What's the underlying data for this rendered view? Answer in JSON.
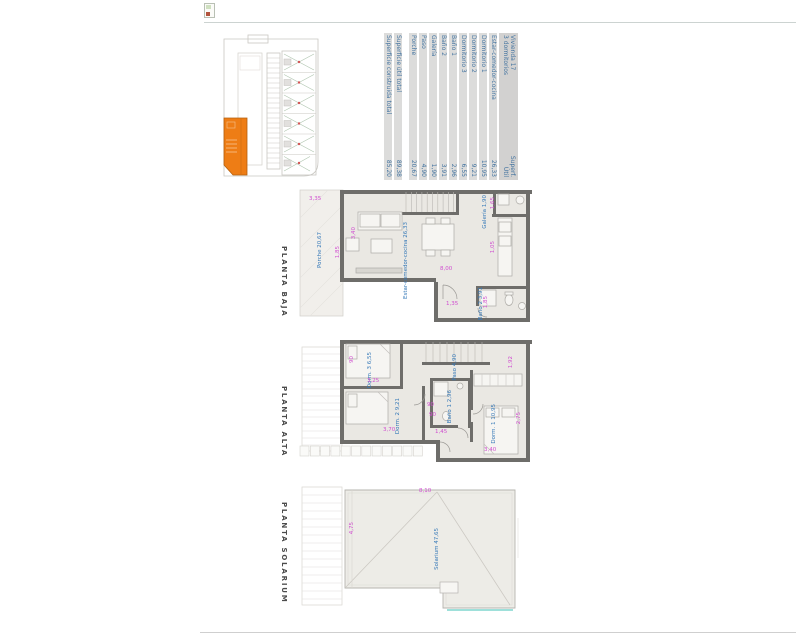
{
  "page": {
    "top_icon": "image-placeholder-icon",
    "background": "#ffffff"
  },
  "colors": {
    "highlight_orange": "#ee7d15",
    "label_blue": "#3679b8",
    "dimension_magenta": "#d04ed0",
    "teal_accent": "#7ed6cd",
    "table_strip_gray": "#dcdcdb",
    "wall_gray": "#6e6d6a"
  },
  "table": {
    "header": {
      "title_line1": "Vivienda 17",
      "title_line2": "3 dormitorios",
      "unit_line1": "Superf.",
      "unit_line2": "Útil"
    },
    "rows": [
      {
        "label": "Estar-comedor-cocina",
        "value": "26,33"
      },
      {
        "label": "Dormitorio 1",
        "value": "10,95"
      },
      {
        "label": "Dormitorio 2",
        "value": "9,21"
      },
      {
        "label": "Dormitorio 3",
        "value": "6,55"
      },
      {
        "label": "Baño 1",
        "value": "2,96"
      },
      {
        "label": "Baño 2",
        "value": "3,91"
      },
      {
        "label": "Galería",
        "value": "1,90"
      },
      {
        "label": "Paso",
        "value": "4,90"
      },
      {
        "label": "Porche",
        "value": "20,67"
      }
    ],
    "totals": [
      {
        "label": "Superficie útil total",
        "value": "89,38"
      },
      {
        "label": "Superficie construida total",
        "value": "85,20"
      }
    ]
  },
  "site_plan": {
    "highlighted_unit": "Vivienda 17"
  },
  "plans": {
    "baja": {
      "title": "PLANTA BAJA",
      "labels": [
        {
          "text": "Porche 20,67",
          "x": 317,
          "y": 232,
          "dir": "v",
          "c": "blue"
        },
        {
          "text": "Estar-comedor-cocina 26,33",
          "x": 403,
          "y": 222,
          "dir": "v",
          "c": "blue"
        },
        {
          "text": "Galería 1,90",
          "x": 482,
          "y": 195,
          "dir": "v",
          "c": "blue"
        },
        {
          "text": "Baño 2 3,91",
          "x": 478,
          "y": 287,
          "dir": "v",
          "c": "blue"
        },
        {
          "text": "3,35",
          "x": 309,
          "y": 196,
          "dir": "h",
          "c": "magenta"
        },
        {
          "text": "1,85",
          "x": 335,
          "y": 246,
          "dir": "v",
          "c": "magenta"
        },
        {
          "text": "3,40",
          "x": 351,
          "y": 227,
          "dir": "v",
          "c": "magenta"
        },
        {
          "text": "8,00",
          "x": 440,
          "y": 266,
          "dir": "h",
          "c": "magenta"
        },
        {
          "text": "1,35",
          "x": 446,
          "y": 301,
          "dir": "h",
          "c": "magenta"
        },
        {
          "text": "1,65",
          "x": 490,
          "y": 197,
          "dir": "v",
          "c": "magenta"
        },
        {
          "text": "1,05",
          "x": 490,
          "y": 241,
          "dir": "v",
          "c": "magenta"
        },
        {
          "text": "1,85",
          "x": 483,
          "y": 296,
          "dir": "v",
          "c": "magenta"
        }
      ]
    },
    "alta": {
      "title": "PLANTA ALTA",
      "labels": [
        {
          "text": "Dorm. 3 6,55",
          "x": 367,
          "y": 352,
          "dir": "v",
          "c": "blue"
        },
        {
          "text": "Dorm. 2 9,21",
          "x": 395,
          "y": 398,
          "dir": "v",
          "c": "blue"
        },
        {
          "text": "Paso 4,90",
          "x": 452,
          "y": 354,
          "dir": "v",
          "c": "blue"
        },
        {
          "text": "Baño 1 2,96",
          "x": 447,
          "y": 390,
          "dir": "v",
          "c": "blue"
        },
        {
          "text": "Dorm. 1 10,95",
          "x": 491,
          "y": 404,
          "dir": "v",
          "c": "blue"
        },
        {
          "text": "3,25",
          "x": 367,
          "y": 378,
          "dir": "h",
          "c": "magenta"
        },
        {
          "text": "3,70",
          "x": 383,
          "y": 427,
          "dir": "h",
          "c": "magenta"
        },
        {
          "text": "1,45",
          "x": 435,
          "y": 429,
          "dir": "h",
          "c": "magenta"
        },
        {
          "text": "1,92",
          "x": 508,
          "y": 356,
          "dir": "v",
          "c": "magenta"
        },
        {
          "text": "2,75",
          "x": 516,
          "y": 412,
          "dir": "v",
          "c": "magenta"
        },
        {
          "text": "3,40",
          "x": 484,
          "y": 447,
          "dir": "h",
          "c": "magenta"
        },
        {
          "text": "90",
          "x": 427,
          "y": 402,
          "dir": "h",
          "c": "magenta"
        },
        {
          "text": "90",
          "x": 429,
          "y": 412,
          "dir": "h",
          "c": "magenta"
        },
        {
          "text": "90",
          "x": 349,
          "y": 356,
          "dir": "v",
          "c": "magenta"
        }
      ]
    },
    "solarium": {
      "title": "PLANTA SOLARIUM",
      "labels": [
        {
          "text": "Solarium 47,65",
          "x": 434,
          "y": 528,
          "dir": "v",
          "c": "blue"
        },
        {
          "text": "8,10",
          "x": 419,
          "y": 488,
          "dir": "h",
          "c": "magenta"
        },
        {
          "text": "4,75",
          "x": 349,
          "y": 522,
          "dir": "v",
          "c": "magenta"
        }
      ]
    }
  }
}
